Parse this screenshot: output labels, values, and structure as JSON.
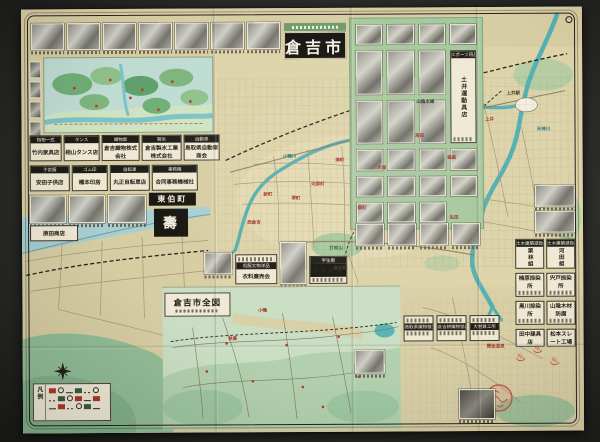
{
  "title": {
    "text": "倉吉市"
  },
  "map": {
    "town_banner": "東伯町",
    "inset_title": "倉吉市全図",
    "legend_title": "凡例",
    "labels": [
      {
        "t": "上井駅",
        "x": 492,
        "y": 86,
        "c": "k"
      },
      {
        "t": "上井",
        "x": 468,
        "y": 112,
        "c": "r"
      },
      {
        "t": "福庭",
        "x": 430,
        "y": 150,
        "c": "r"
      },
      {
        "t": "海田",
        "x": 398,
        "y": 128,
        "c": "r"
      },
      {
        "t": "大塚",
        "x": 360,
        "y": 160,
        "c": "r"
      },
      {
        "t": "湊町",
        "x": 318,
        "y": 152,
        "c": "r"
      },
      {
        "t": "河原町",
        "x": 296,
        "y": 176,
        "c": "r"
      },
      {
        "t": "堺町",
        "x": 274,
        "y": 190,
        "c": "r"
      },
      {
        "t": "新町",
        "x": 246,
        "y": 186,
        "c": "r"
      },
      {
        "t": "西倉吉",
        "x": 232,
        "y": 214,
        "c": "r"
      },
      {
        "t": "葵町",
        "x": 340,
        "y": 200,
        "c": "r"
      },
      {
        "t": "倉吉駅",
        "x": 318,
        "y": 260,
        "c": "k"
      },
      {
        "t": "打吹山",
        "x": 314,
        "y": 240,
        "c": "g"
      },
      {
        "t": "小鴨川",
        "x": 268,
        "y": 148,
        "c": "b"
      },
      {
        "t": "天神川",
        "x": 522,
        "y": 122,
        "c": "b"
      },
      {
        "t": "山陰本線",
        "x": 404,
        "y": 94,
        "c": "k"
      },
      {
        "t": "生田",
        "x": 432,
        "y": 210,
        "c": "r"
      },
      {
        "t": "小鴨",
        "x": 240,
        "y": 302,
        "c": "r"
      },
      {
        "t": "秋喜",
        "x": 210,
        "y": 330,
        "c": "r"
      },
      {
        "t": "関金温泉",
        "x": 473,
        "y": 339,
        "c": "r"
      }
    ]
  },
  "icons": {
    "hot_spring_symbol": "♨"
  },
  "ads": {
    "left_row1": [
      {
        "header": "指物一式",
        "name": "竹内家具店"
      },
      {
        "header": "タンス",
        "name": "相山タンス店"
      },
      {
        "header": "織物卸",
        "name": "倉吉織物株式会社"
      },
      {
        "header": "製氷",
        "name": "倉吉製氷工業株式会社"
      },
      {
        "header": "自動車",
        "name": "鳥取県自動車商会"
      }
    ],
    "left_row2": [
      {
        "header": "子供服",
        "name": "安田子供店"
      },
      {
        "header": "ゴム印",
        "name": "橋本印房"
      },
      {
        "header": "自転車",
        "name": "丸正自転車店"
      },
      {
        "header": "事務機",
        "name": "合同事務機械社"
      }
    ],
    "harada": {
      "name": "原田商店"
    },
    "kotobuki": {
      "name": "壽"
    },
    "doi": {
      "header": "スポーツ用品",
      "name": "土井運動具店"
    },
    "right_column": [
      {
        "header": "土木建築請負",
        "name": "栗林組"
      },
      {
        "header": "土木建築請負",
        "name": "河田組"
      },
      {
        "name": "楠原捺染所"
      },
      {
        "name": "宍戸捺染所"
      },
      {
        "name": "黒川捺染所"
      },
      {
        "name": "山陰木材防腐"
      },
      {
        "name": "田中建具店"
      },
      {
        "name": "松本スレート工場"
      }
    ],
    "bottom_center": [
      {
        "header": "呉服太物洋品",
        "name": "衣料廉売会"
      },
      {
        "header": "学生服",
        "name": "小学生服"
      }
    ],
    "bottom_right": [
      {
        "name": "鳥取県織物検査所"
      },
      {
        "name": "倉吉絣織物協同組合"
      },
      {
        "name": "大村鉄工所"
      }
    ]
  }
}
